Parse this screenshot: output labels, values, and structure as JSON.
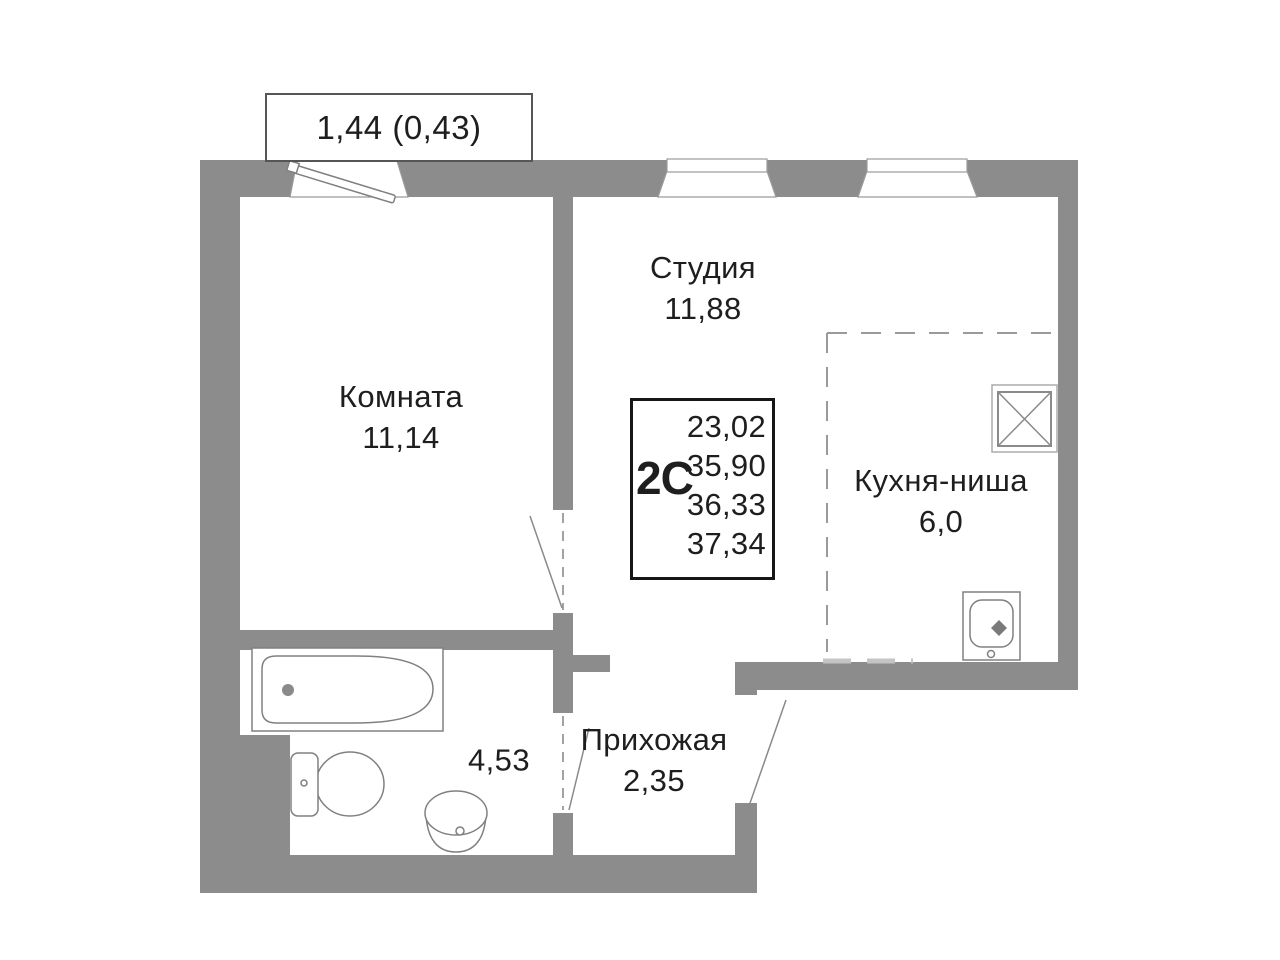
{
  "balcony": {
    "label": "1,44 (0,43)"
  },
  "rooms": {
    "room": {
      "label": "Комната",
      "area": "11,14"
    },
    "studio": {
      "label": "Студия",
      "area": "11,88"
    },
    "kitchen": {
      "label": "Кухня-ниша",
      "area": "6,0"
    },
    "hallway": {
      "label": "Прихожая",
      "area": "2,35"
    },
    "bathroom": {
      "area": "4,53"
    }
  },
  "info_box": {
    "type": "2С",
    "areas": [
      "23,02",
      "35,90",
      "36,33",
      "37,34"
    ]
  },
  "icons": {
    "fixtures": [
      "bathtub",
      "toilet",
      "pedestal-sink",
      "kitchen-sink",
      "ventilation-shaft",
      "balcony-door-leaf",
      "window",
      "door-swing",
      "kitchen-niche-dashed-boundary"
    ]
  },
  "colors": {
    "wall": "#8c8c8c",
    "outline": "#8a8a8a",
    "text": "#1e1e1e",
    "dash": "#9a9a9a",
    "info_border": "#161616"
  }
}
